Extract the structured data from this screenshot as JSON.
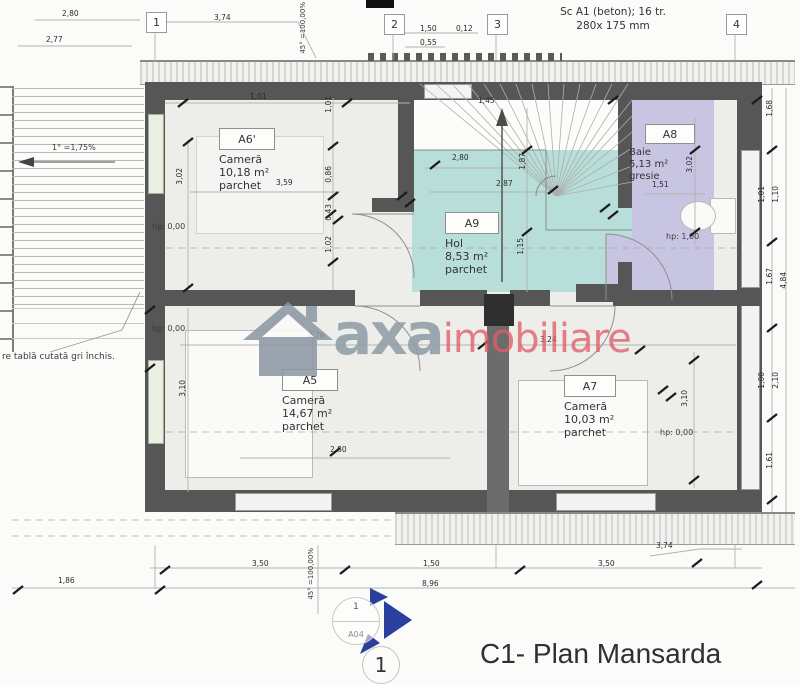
{
  "title_block": {
    "detail_number": "1",
    "title": "C1- Plan Mansarda"
  },
  "stair_note": {
    "line1": "Sc A1 (beton); 16 tr.",
    "line2": "280x 175 mm"
  },
  "grid_markers": [
    {
      "label": "1"
    },
    {
      "label": "2"
    },
    {
      "label": "3"
    },
    {
      "label": "4"
    }
  ],
  "rooms": [
    {
      "id": "A6'",
      "name": "Cameră",
      "area": "10,18 m²",
      "finish": "parchet"
    },
    {
      "id": "A9",
      "name": "Hol",
      "area": "8,53 m²",
      "finish": "parchet"
    },
    {
      "id": "A8",
      "name": "Baie",
      "area": "5,13 m²",
      "finish": "gresie"
    },
    {
      "id": "A5",
      "name": "Cameră",
      "area": "14,67 m²",
      "finish": "parchet"
    },
    {
      "id": "A7",
      "name": "Cameră",
      "area": "10,03 m²",
      "finish": "parchet"
    }
  ],
  "height_labels": [
    {
      "text": "hp: 0,00",
      "x": 152,
      "y": 222
    },
    {
      "text": "hp: 0,00",
      "x": 152,
      "y": 324
    },
    {
      "text": "hp: 1,00",
      "x": 666,
      "y": 232
    },
    {
      "text": "hp: 0,00",
      "x": 660,
      "y": 428
    }
  ],
  "slope_labels": [
    {
      "text": "45° =100,00%",
      "x": 299,
      "y": 2,
      "v": true
    },
    {
      "text": "45° =100,00%",
      "x": 307,
      "y": 548,
      "v": true
    },
    {
      "text": "1° =1,75%",
      "x": 52,
      "y": 143,
      "v": false
    }
  ],
  "material_note": {
    "text": "re tablă cutată gri închis."
  },
  "dimensions": [
    {
      "text": "2,80",
      "x": 62,
      "y": 10
    },
    {
      "text": "2,77",
      "x": 46,
      "y": 36
    },
    {
      "text": "3,74",
      "x": 214,
      "y": 14
    },
    {
      "text": "1,50",
      "x": 420,
      "y": 25
    },
    {
      "text": "0,12",
      "x": 456,
      "y": 25
    },
    {
      "text": "0,55",
      "x": 420,
      "y": 39
    },
    {
      "text": "1,01",
      "x": 250,
      "y": 93
    },
    {
      "text": "1,45",
      "x": 478,
      "y": 97
    },
    {
      "text": "3,59",
      "x": 276,
      "y": 179
    },
    {
      "text": "2,80",
      "x": 452,
      "y": 154
    },
    {
      "text": "2,87",
      "x": 496,
      "y": 180
    },
    {
      "text": "1,51",
      "x": 652,
      "y": 181
    },
    {
      "text": "4,76",
      "x": 308,
      "y": 332
    },
    {
      "text": "3,24",
      "x": 540,
      "y": 336
    },
    {
      "text": "2,80",
      "x": 330,
      "y": 446
    },
    {
      "text": "1,86",
      "x": 58,
      "y": 577
    },
    {
      "text": "3,50",
      "x": 252,
      "y": 560
    },
    {
      "text": "1,50",
      "x": 423,
      "y": 560
    },
    {
      "text": "3,50",
      "x": 598,
      "y": 560
    },
    {
      "text": "8,96",
      "x": 422,
      "y": 580
    },
    {
      "text": "3,74",
      "x": 656,
      "y": 542
    },
    {
      "text": "3,02",
      "x": 176,
      "y": 168,
      "v": true
    },
    {
      "text": "1,01",
      "x": 325,
      "y": 96,
      "v": true
    },
    {
      "text": "0,86",
      "x": 325,
      "y": 166,
      "v": true
    },
    {
      "text": "0,43",
      "x": 325,
      "y": 204,
      "v": true
    },
    {
      "text": "1,02",
      "x": 325,
      "y": 236,
      "v": true
    },
    {
      "text": "1,87",
      "x": 519,
      "y": 153,
      "v": true
    },
    {
      "text": "1,15",
      "x": 517,
      "y": 238,
      "v": true
    },
    {
      "text": "3,02",
      "x": 686,
      "y": 156,
      "v": true
    },
    {
      "text": "3,10",
      "x": 179,
      "y": 380,
      "v": true
    },
    {
      "text": "3,10",
      "x": 681,
      "y": 390,
      "v": true
    },
    {
      "text": "1,68",
      "x": 766,
      "y": 100,
      "v": true
    },
    {
      "text": "1,01",
      "x": 758,
      "y": 186,
      "v": true
    },
    {
      "text": "1,10",
      "x": 772,
      "y": 186,
      "v": true
    },
    {
      "text": "1,67",
      "x": 766,
      "y": 268,
      "v": true
    },
    {
      "text": "4,84",
      "x": 780,
      "y": 272,
      "v": true
    },
    {
      "text": "1,00",
      "x": 758,
      "y": 372,
      "v": true
    },
    {
      "text": "2,10",
      "x": 772,
      "y": 372,
      "v": true
    },
    {
      "text": "1,61",
      "x": 766,
      "y": 452,
      "v": true
    }
  ],
  "watermark": {
    "word1": "axa",
    "word2": "imobiliare",
    "icon": "house-icon"
  },
  "section_marker": {
    "number": "1",
    "sheet": "A04"
  },
  "colors": {
    "hall_fill": "#b7ded8",
    "bath_fill": "#c8c5e3",
    "wall": "#565656",
    "watermark_gray": "#919ea9",
    "watermark_red": "#e05c68",
    "marker_blue": "#2b3f9e"
  }
}
